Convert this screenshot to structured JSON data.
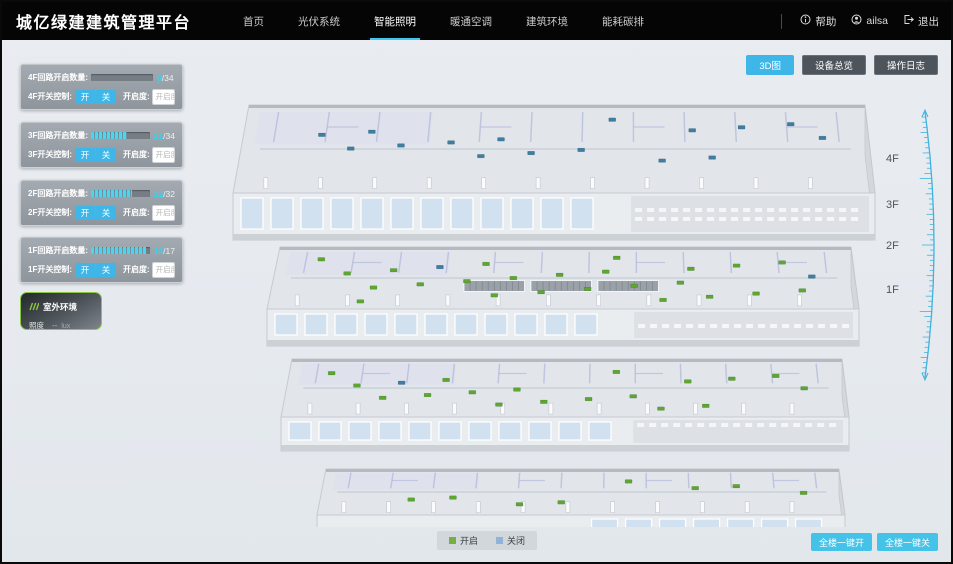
{
  "navbar": {
    "title": "城亿绿建建筑管理平台",
    "items": [
      {
        "label": "首页",
        "active": false
      },
      {
        "label": "光伏系统",
        "active": false
      },
      {
        "label": "智能照明",
        "active": true
      },
      {
        "label": "暖通空调",
        "active": false
      },
      {
        "label": "建筑环境",
        "active": false
      },
      {
        "label": "能耗碳排",
        "active": false
      }
    ],
    "help_label": "帮助",
    "username": "ailsa",
    "logout_label": "退出"
  },
  "floor_panels": [
    {
      "circuit_label": "4F回路开启数量:",
      "open": 0,
      "total": 34,
      "count_suffix": "/34",
      "switch_label": "4F开关控制:",
      "on_label": "开",
      "off_label": "关",
      "dim_label": "开启度:",
      "dim_placeholder": "开启度",
      "percent_label": "%"
    },
    {
      "circuit_label": "3F回路开启数量:",
      "open": 21,
      "total": 34,
      "count_suffix": "/34",
      "switch_label": "3F开关控制:",
      "on_label": "开",
      "off_label": "关",
      "dim_label": "开启度:",
      "dim_placeholder": "开启度",
      "percent_label": "%"
    },
    {
      "circuit_label": "2F回路开启数量:",
      "open": 22,
      "total": 32,
      "count_suffix": "/32",
      "switch_label": "2F开关控制:",
      "on_label": "开",
      "off_label": "关",
      "dim_label": "开启度:",
      "dim_placeholder": "开启度",
      "percent_label": "%"
    },
    {
      "circuit_label": "1F回路开启数量:",
      "open": 16,
      "total": 17,
      "count_suffix": "/17",
      "switch_label": "1F开关控制:",
      "on_label": "开",
      "off_label": "关",
      "dim_label": "开启度:",
      "dim_placeholder": "开启度",
      "percent_label": "%"
    }
  ],
  "outdoor_panel": {
    "title": "室外环境",
    "illuminance_label": "照度",
    "illuminance_value": "--",
    "illuminance_unit": "lux"
  },
  "view_toolbar": [
    {
      "label": "3D图",
      "active": true
    },
    {
      "label": "设备总览",
      "active": false
    },
    {
      "label": "操作日志",
      "active": false
    }
  ],
  "floor_axis_labels": [
    "4F",
    "3F",
    "2F",
    "1F"
  ],
  "building": {
    "floors": [
      {
        "name": "4F",
        "markers_open": 0,
        "markers_closed": 16
      },
      {
        "name": "3F",
        "markers_open": 24,
        "markers_closed": 2
      },
      {
        "name": "2F",
        "markers_open": 18,
        "markers_closed": 1
      },
      {
        "name": "1F",
        "markers_open": 8,
        "markers_closed": 0
      }
    ]
  },
  "legend": {
    "open_label": "开启",
    "closed_label": "关闭"
  },
  "bulk_controls": {
    "all_on_label": "全楼一键开",
    "all_off_label": "全楼一键关"
  },
  "colors": {
    "accent": "#3eb7e8",
    "marker_open": "#5ca631",
    "marker_closed": "#3e7ea2",
    "legend_open": "#76b043",
    "legend_closed": "#8fb4d8",
    "outdoor_border": "#8cc63e"
  }
}
